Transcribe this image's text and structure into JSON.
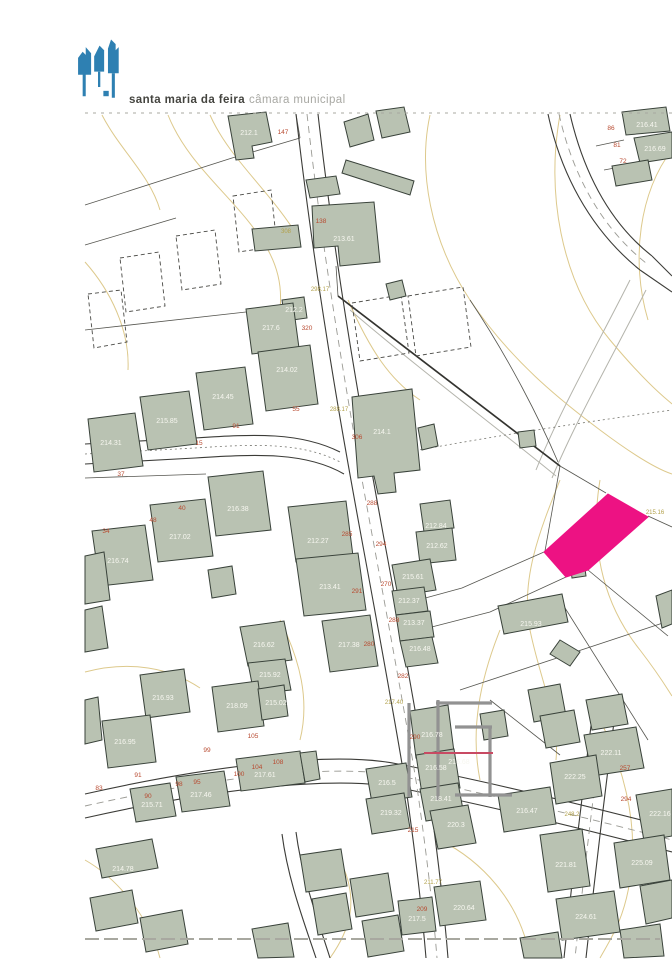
{
  "header": {
    "brand_bold": "santa maria da feira",
    "brand_light": "câmara municipal",
    "logo_color": "#2e80b2"
  },
  "map": {
    "colors": {
      "building_fill": "#b9c2b2",
      "building_stroke": "#39423a",
      "road_casing": "#3c3c38",
      "centerline": "#9a9a94",
      "contour": "#ddc98c",
      "boundary": "#55554f",
      "track": "#b4b4ac",
      "dashed_lot": "#4a4a46",
      "highlight": "#ed1283",
      "watermark": "#929292",
      "watermark_accent": "#c84a63",
      "label_elev": "#f7f7f0",
      "label_red": "#b84a30",
      "label_olive": "#b2a14b",
      "scan_mark": "#a8a8a0"
    },
    "contours": [
      "M168,115 C190,170 240,200 268,250 C290,290 280,330 262,360",
      "M102,115 C120,150 150,175 160,210",
      "M85,262 C110,290 130,330 128,370",
      "M430,115 C418,170 430,240 470,300 C510,360 560,400 600,430 C640,460 660,470 672,474",
      "M560,115 C546,190 560,280 610,340 C650,388 668,400 672,404",
      "M672,150 C640,190 630,260 648,320",
      "M348,300 C370,350 390,380 420,400",
      "M85,672 C130,660 170,668 200,688",
      "M280,620 C300,660 310,700 300,740",
      "M560,480 C540,530 520,580 530,630 C540,680 560,720 556,760",
      "M600,480 C590,540 600,600 640,650 C660,676 668,690 672,696",
      "M440,840 C480,860 520,900 530,958",
      "M340,860 C360,900 350,930 330,958",
      "M85,860 C120,880 150,920 160,958",
      "M600,720 C620,760 640,820 630,880 C624,920 610,940 600,958",
      "M500,630 C480,680 470,730 480,780",
      "M210,115 C230,160 270,190 300,240"
    ],
    "tracks": [
      "M630,280 C600,340 560,410 536,470",
      "M646,290 C616,350 576,420 552,478",
      "M350,310 C420,370 500,430 556,476"
    ],
    "boundaries": [
      "M85,205 L232,158 L300,138",
      "M85,245 L176,218",
      "M300,138 L296,114",
      "M560,466 L545,551",
      "M560,466 L606,493",
      "M648,516 L672,527",
      "M588,570 L668,636",
      "M544,552 L462,588 L396,606",
      "M566,577 L490,612 L420,630",
      "M470,300 C510,360 540,420 558,462",
      "M460,690 L672,620",
      "M336,266 L338,296",
      "M85,330 L246,312",
      "M85,478 L206,474",
      "M560,600 L648,740",
      "M624,140 L596,146",
      "M636,164 L604,170",
      "M490,700 L560,755"
    ],
    "thick_boundaries": [
      "M338,296 L560,466"
    ],
    "road_casings": [
      "M296,114 C308,220 322,310 336,394 C350,478 362,540 374,606 C386,672 398,738 406,788 C416,858 422,910 426,958",
      "M318,114 C330,220 344,310 358,392 C372,476 384,538 396,604 C408,670 420,736 428,786 C438,856 444,908 448,958",
      "M85,444 L195,438 C255,434 300,432 340,452",
      "M85,464 L195,458 C258,454 306,452 344,474",
      "M85,794 C200,768 330,750 398,764 C480,780 580,804 672,828",
      "M85,818 C200,792 330,774 400,788 C480,804 580,828 672,852",
      "M592,718 C584,780 574,862 564,958",
      "M614,722 C606,784 596,866 586,958",
      "M548,114 C560,170 588,228 640,270",
      "M570,114 C582,166 606,220 652,256",
      "M640,270 L672,292",
      "M652,256 L672,276",
      "M296,832 C302,878 318,920 330,958",
      "M282,834 C288,880 304,922 316,958"
    ],
    "centerlines": [
      "M307,114 C319,220 333,310 347,393 C361,477 373,539 385,605 C397,671 409,737 417,787 C427,857 433,909 437,958",
      "M85,806 C200,780 330,762 399,776 C480,792 580,816 672,840",
      "M603,720 C595,782 585,864 575,958",
      "M559,114 C571,168 597,224 646,263"
    ],
    "dotted_lines": [
      "M85,454 L195,448 C256,444 303,442 342,463",
      "M376,458 C470,440 570,424 672,410"
    ],
    "dashed_lots": [
      "233,196 271,190 277,246 239,252",
      "176,236 215,230 221,284 182,290",
      "120,258 159,252 165,306 126,312",
      "88,294 121,290 127,342 94,348",
      "408,296 463,287 471,347 416,356",
      "352,303 401,295 409,353 360,361"
    ],
    "buildings": [
      "228,116 266,112 272,142 252,146 254,158 236,160",
      "344,122 368,114 374,140 350,147",
      "376,111 404,107 410,132 382,138",
      "346,160 414,181 410,195 342,173",
      "386,284 402,280 406,296 390,300",
      "312,206 374,202 380,262 340,266 338,246 314,248",
      "252,229 298,225 301,247 255,251",
      "622,112 666,107 670,131 626,135",
      "634,138 672,132 672,158 640,163",
      "612,166 648,160 652,180 616,186",
      "306,180 336,176 340,194 310,198",
      "282,300 304,297 307,318 285,321",
      "246,309 293,303 299,348 252,354",
      "258,352 310,345 318,404 266,411",
      "196,373 245,367 253,424 204,430",
      "140,397 189,391 197,444 148,450",
      "88,419 135,413 143,466 94,472",
      "352,397 412,389 420,470 394,473 396,492 378,494 374,476 358,478",
      "418,428 434,424 438,446 422,450",
      "208,477 263,471 271,530 216,536",
      "150,505 205,499 213,556 158,562",
      "92,531 145,525 153,580 100,586",
      "288,507 346,501 353,556 296,562",
      "296,559 358,553 366,610 304,616",
      "420,504 450,500 454,528 424,532",
      "416,532 452,528 456,560 420,564",
      "392,565 430,559 436,590 398,596",
      "392,591 424,587 428,611 396,615",
      "396,615 430,611 434,637 400,641",
      "400,641 432,637 438,663 406,667",
      "322,621 370,615 378,666 330,672",
      "240,627 284,621 292,660 248,666",
      "248,663 285,659 291,690 254,694",
      "85,556 104,552 110,600 85,604",
      "85,610 102,606 108,648 85,652",
      "208,570 232,566 236,594 212,598",
      "140,675 184,669 190,712 146,718",
      "212,687 258,681 264,726 218,732",
      "258,689 284,685 288,716 262,720",
      "102,721 150,715 156,762 108,768",
      "85,700 98,697 102,740 85,744",
      "236,759 300,751 305,783 241,791",
      "300,753 316,751 320,779 305,782",
      "176,777 224,771 230,806 182,812",
      "130,789 170,783 176,816 136,822",
      "96,849 152,839 158,868 102,878",
      "90,898 132,890 138,923 96,931",
      "140,918 182,910 188,944 146,952",
      "300,855 341,849 347,886 306,892",
      "350,879 388,873 394,911 356,917",
      "312,899 346,893 352,929 318,935",
      "362,921 398,915 404,951 368,957",
      "252,929 288,923 294,957 258,958",
      "410,711 448,705 454,752 416,758",
      "416,755 454,749 460,788 422,794",
      "366,769 406,763 412,797 372,803",
      "420,789 458,783 464,815 426,821",
      "366,799 404,793 410,828 372,834",
      "430,811 468,805 476,843 438,849",
      "498,795 550,787 556,824 504,832",
      "480,714 504,710 508,736 484,740",
      "498,606 562,594 568,622 504,634",
      "560,640 580,652 570,666 550,654",
      "584,735 636,727 644,768 592,776",
      "586,700 622,694 628,724 592,730",
      "550,763 596,755 602,796 556,804",
      "636,795 672,789 672,836 644,841",
      "614,843 664,835 670,880 620,888",
      "540,835 582,829 590,886 548,892",
      "556,899 614,891 620,932 562,940",
      "434,887 480,881 486,920 440,926",
      "398,901 432,897 436,931 402,935",
      "518,432 534,430 536,446 520,448",
      "570,564 584,562 586,576 572,578",
      "640,886 672,880 672,918 646,924",
      "520,938 558,932 562,958 524,958",
      "620,930 660,924 664,956 624,958",
      "656,596 672,590 672,624 662,628",
      "528,690 560,684 566,716 534,722",
      "540,716 574,710 580,742 546,748"
    ],
    "highlight_parcel": {
      "points": "608,494 648,517 588,570 566,577 544,552"
    },
    "watermark": {
      "strokes": [
        "M409,703 L409,797",
        "M438,700 L438,800",
        "M436,703 L492,703",
        "M455,727 L492,727",
        "M490,727 L490,797",
        "M455,795 L512,795"
      ],
      "accent": "M424,753 L493,753"
    },
    "labels": {
      "elevation": [
        {
          "t": "212.1",
          "x": 249,
          "y": 135
        },
        {
          "t": "213.61",
          "x": 344,
          "y": 241
        },
        {
          "t": "216.41",
          "x": 647,
          "y": 127
        },
        {
          "t": "216.69",
          "x": 655,
          "y": 151
        },
        {
          "t": "212.2",
          "x": 294,
          "y": 312
        },
        {
          "t": "217.6",
          "x": 271,
          "y": 330
        },
        {
          "t": "214.02",
          "x": 287,
          "y": 372
        },
        {
          "t": "214.45",
          "x": 223,
          "y": 399
        },
        {
          "t": "215.85",
          "x": 167,
          "y": 423
        },
        {
          "t": "214.31",
          "x": 111,
          "y": 445
        },
        {
          "t": "214.1",
          "x": 382,
          "y": 434
        },
        {
          "t": "216.38",
          "x": 238,
          "y": 511
        },
        {
          "t": "217.02",
          "x": 180,
          "y": 539
        },
        {
          "t": "216.74",
          "x": 118,
          "y": 563
        },
        {
          "t": "212.27",
          "x": 318,
          "y": 543
        },
        {
          "t": "213.41",
          "x": 330,
          "y": 589
        },
        {
          "t": "212.84",
          "x": 436,
          "y": 528
        },
        {
          "t": "212.62",
          "x": 437,
          "y": 548
        },
        {
          "t": "215.61",
          "x": 413,
          "y": 579
        },
        {
          "t": "212.37",
          "x": 409,
          "y": 603
        },
        {
          "t": "213.37",
          "x": 414,
          "y": 625
        },
        {
          "t": "216.48",
          "x": 420,
          "y": 651
        },
        {
          "t": "217.38",
          "x": 349,
          "y": 647
        },
        {
          "t": "216.62",
          "x": 264,
          "y": 647
        },
        {
          "t": "215.92",
          "x": 270,
          "y": 677
        },
        {
          "t": "216.93",
          "x": 163,
          "y": 700
        },
        {
          "t": "218.09",
          "x": 237,
          "y": 708
        },
        {
          "t": "215.02",
          "x": 276,
          "y": 705
        },
        {
          "t": "216.95",
          "x": 125,
          "y": 744
        },
        {
          "t": "217.61",
          "x": 265,
          "y": 777
        },
        {
          "t": "217.46",
          "x": 201,
          "y": 797
        },
        {
          "t": "215.71",
          "x": 152,
          "y": 807
        },
        {
          "t": "214.78",
          "x": 123,
          "y": 871
        },
        {
          "t": "216.78",
          "x": 432,
          "y": 737
        },
        {
          "t": "216.68",
          "x": 459,
          "y": 764
        },
        {
          "t": "216.58",
          "x": 436,
          "y": 770
        },
        {
          "t": "216.5",
          "x": 387,
          "y": 785
        },
        {
          "t": "218.41",
          "x": 441,
          "y": 801
        },
        {
          "t": "219.32",
          "x": 391,
          "y": 815
        },
        {
          "t": "220.3",
          "x": 456,
          "y": 827
        },
        {
          "t": "216.47",
          "x": 527,
          "y": 813
        },
        {
          "t": "215.93",
          "x": 531,
          "y": 626
        },
        {
          "t": "222.11",
          "x": 611,
          "y": 755
        },
        {
          "t": "222.25",
          "x": 575,
          "y": 779
        },
        {
          "t": "222.16",
          "x": 660,
          "y": 816
        },
        {
          "t": "225.09",
          "x": 642,
          "y": 865
        },
        {
          "t": "221.81",
          "x": 566,
          "y": 867
        },
        {
          "t": "224.61",
          "x": 586,
          "y": 919
        },
        {
          "t": "220.64",
          "x": 464,
          "y": 910
        },
        {
          "t": "217.5",
          "x": 417,
          "y": 921
        }
      ],
      "red": [
        {
          "t": "147",
          "x": 283,
          "y": 134
        },
        {
          "t": "138",
          "x": 321,
          "y": 223
        },
        {
          "t": "320",
          "x": 307,
          "y": 330
        },
        {
          "t": "306",
          "x": 357,
          "y": 439
        },
        {
          "t": "288",
          "x": 372,
          "y": 505
        },
        {
          "t": "285",
          "x": 347,
          "y": 536
        },
        {
          "t": "294",
          "x": 381,
          "y": 546
        },
        {
          "t": "270",
          "x": 386,
          "y": 586
        },
        {
          "t": "291",
          "x": 357,
          "y": 593
        },
        {
          "t": "288",
          "x": 394,
          "y": 622
        },
        {
          "t": "280",
          "x": 369,
          "y": 646
        },
        {
          "t": "282",
          "x": 403,
          "y": 678
        },
        {
          "t": "55",
          "x": 296,
          "y": 411
        },
        {
          "t": "91",
          "x": 236,
          "y": 428
        },
        {
          "t": "15",
          "x": 199,
          "y": 445
        },
        {
          "t": "37",
          "x": 121,
          "y": 476
        },
        {
          "t": "40",
          "x": 182,
          "y": 510
        },
        {
          "t": "48",
          "x": 153,
          "y": 522
        },
        {
          "t": "34",
          "x": 106,
          "y": 533
        },
        {
          "t": "83",
          "x": 99,
          "y": 790
        },
        {
          "t": "91",
          "x": 138,
          "y": 777
        },
        {
          "t": "90",
          "x": 148,
          "y": 798
        },
        {
          "t": "98",
          "x": 179,
          "y": 786
        },
        {
          "t": "95",
          "x": 197,
          "y": 784
        },
        {
          "t": "99",
          "x": 207,
          "y": 752
        },
        {
          "t": "100",
          "x": 239,
          "y": 776
        },
        {
          "t": "104",
          "x": 257,
          "y": 769
        },
        {
          "t": "108",
          "x": 278,
          "y": 764
        },
        {
          "t": "105",
          "x": 253,
          "y": 738
        },
        {
          "t": "86",
          "x": 611,
          "y": 130
        },
        {
          "t": "81",
          "x": 617,
          "y": 147
        },
        {
          "t": "72",
          "x": 623,
          "y": 163
        },
        {
          "t": "290",
          "x": 415,
          "y": 739
        },
        {
          "t": "215",
          "x": 413,
          "y": 832
        },
        {
          "t": "257",
          "x": 625,
          "y": 770
        },
        {
          "t": "294",
          "x": 626,
          "y": 801
        },
        {
          "t": "209",
          "x": 422,
          "y": 911
        }
      ],
      "olive": [
        {
          "t": "308",
          "x": 286,
          "y": 233
        },
        {
          "t": "298.17",
          "x": 320,
          "y": 291
        },
        {
          "t": "288.17",
          "x": 339,
          "y": 411
        },
        {
          "t": "215.16",
          "x": 655,
          "y": 514
        },
        {
          "t": "217.40",
          "x": 394,
          "y": 704
        },
        {
          "t": "211.77",
          "x": 433,
          "y": 884
        },
        {
          "t": "248.2",
          "x": 572,
          "y": 816
        }
      ]
    },
    "scan_marks": [
      {
        "d": "M85,113 L672,113",
        "w": 1,
        "dash": "3,5"
      },
      {
        "d": "M85,939 L660,939",
        "w": 2,
        "dash": "14,5"
      }
    ]
  }
}
